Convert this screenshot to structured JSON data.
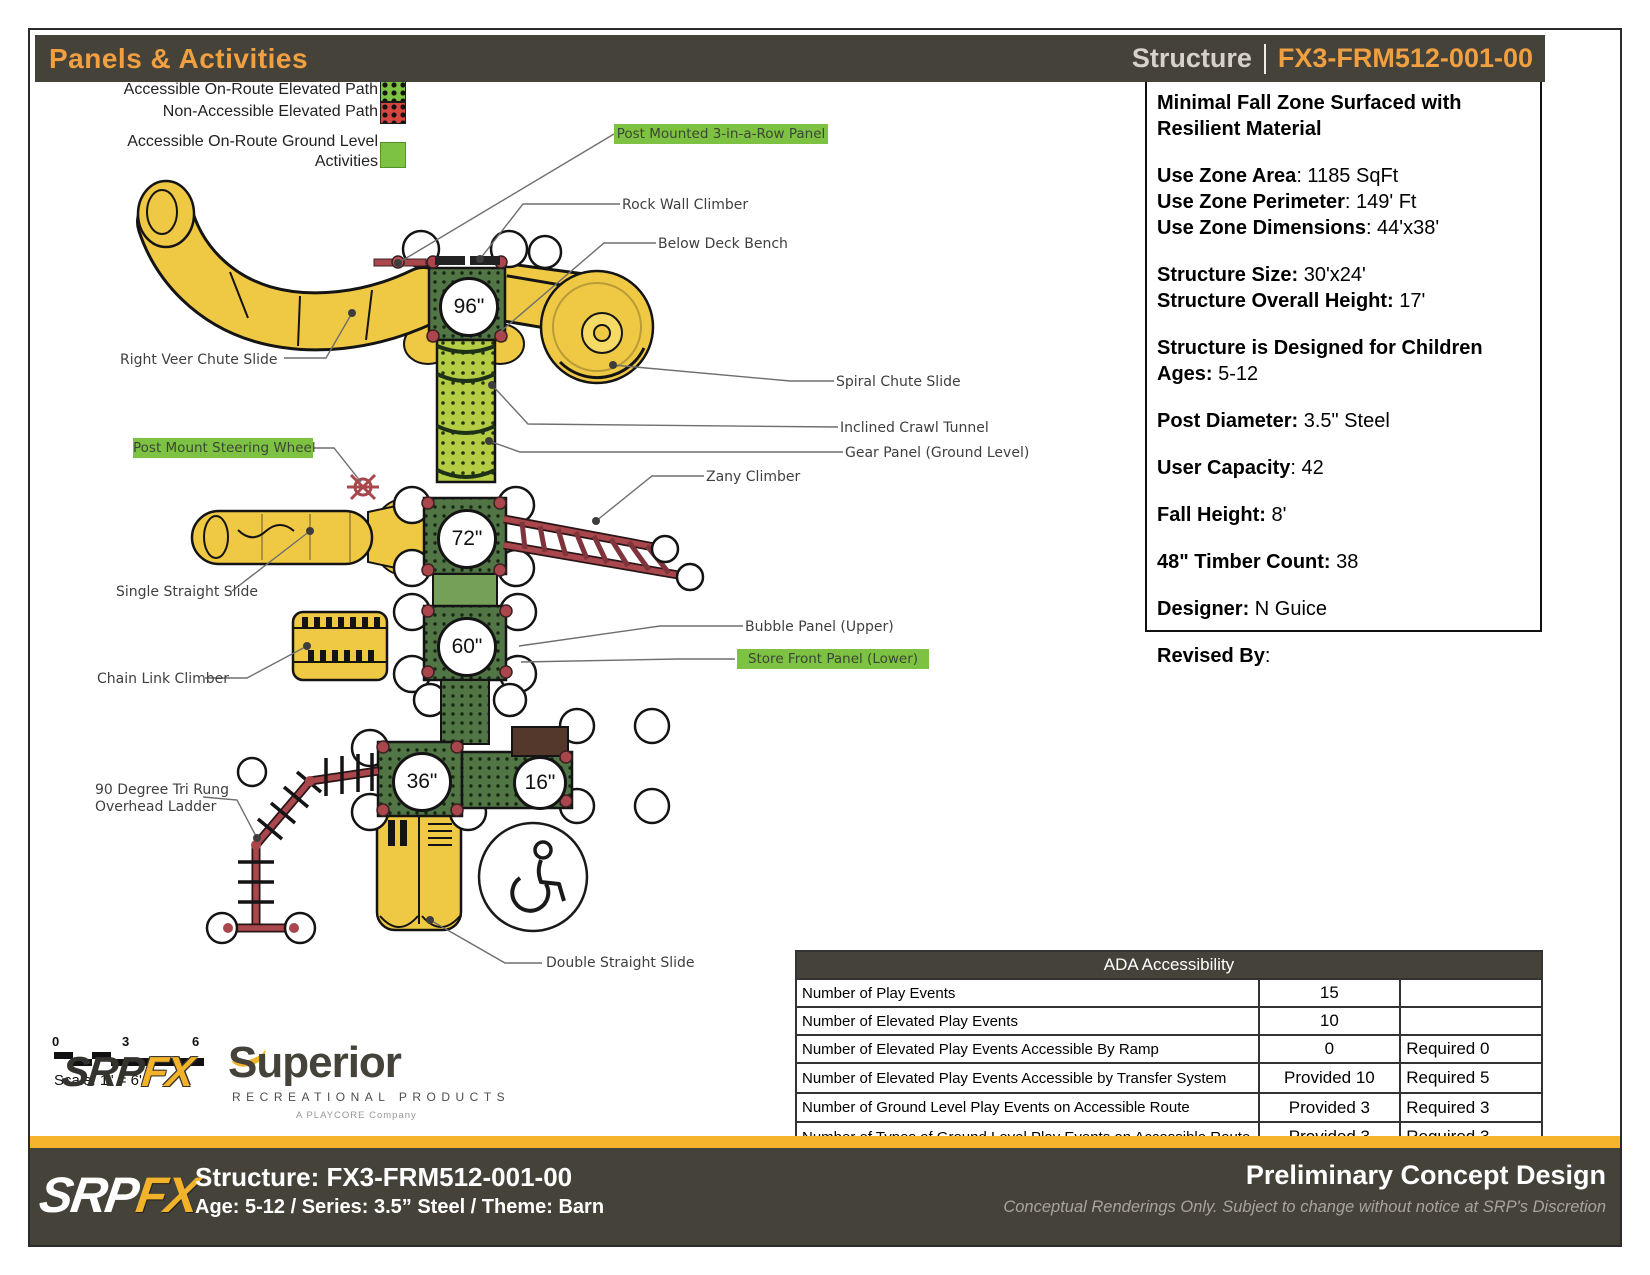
{
  "header": {
    "title": "Panels & Activities",
    "right_label": "Structure",
    "right_code": "FX3-FRM512-001-00"
  },
  "legend": {
    "elevated_accessible": "Accessible On-Route Elevated Path",
    "elevated_non_accessible": "Non-Accessible Elevated Path",
    "ground_line1": "Accessible On-Route Ground Level",
    "ground_line2": "Activities"
  },
  "info_panel": {
    "title": "Minimal Fall Zone Surfaced with Resilient Material",
    "lines": [
      {
        "label": "Use Zone Area",
        "value": ": 1185 SqFt"
      },
      {
        "label": "Use Zone Perimeter",
        "value": ": 149' Ft"
      },
      {
        "label": "Use Zone Dimensions",
        "value": ": 44'x38'"
      },
      {
        "label": "Structure Size:",
        "value": " 30'x24'"
      },
      {
        "label": "Structure Overall Height:",
        "value": " 17'"
      },
      {
        "label": "Structure is Designed for Children Ages:",
        "value": " 5-12"
      },
      {
        "label": "Post Diameter:",
        "value": " 3.5\" Steel"
      },
      {
        "label": "User Capacity",
        "value": ": 42"
      },
      {
        "label": "Fall Height:",
        "value": " 8'"
      },
      {
        "label": "48\" Timber Count:",
        "value": " 38"
      },
      {
        "label": "Designer:",
        "value": " N Guice"
      },
      {
        "label": "Revised By",
        "value": ":"
      }
    ]
  },
  "diagram": {
    "decks": [
      {
        "height": "96\""
      },
      {
        "height": "72\""
      },
      {
        "height": "60\""
      },
      {
        "height": "36\""
      },
      {
        "height": "16\""
      }
    ],
    "callouts": [
      {
        "text": "Post Mounted 3-in-a-Row Panel",
        "highlight": true
      },
      {
        "text": "Rock Wall Climber",
        "highlight": false
      },
      {
        "text": "Below Deck Bench",
        "highlight": false
      },
      {
        "text": "Right Veer Chute Slide",
        "highlight": false
      },
      {
        "text": "Spiral Chute Slide",
        "highlight": false
      },
      {
        "text": "Inclined Crawl Tunnel",
        "highlight": false
      },
      {
        "text": "Gear Panel (Ground Level)",
        "highlight": false
      },
      {
        "text": "Post Mount Steering Wheel",
        "highlight": true
      },
      {
        "text": "Zany Climber",
        "highlight": false
      },
      {
        "text": "Single Straight Slide",
        "highlight": false
      },
      {
        "text": "Bubble Panel (Upper)",
        "highlight": false
      },
      {
        "text": "Store Front Panel (Lower)",
        "highlight": true
      },
      {
        "text": "Chain Link Climber",
        "highlight": false
      },
      {
        "line1": "90 Degree Tri Rung",
        "line2": "Overhead Ladder",
        "highlight": false
      },
      {
        "text": "Double Straight Slide",
        "highlight": false
      }
    ]
  },
  "ada": {
    "title": "ADA Accessibility",
    "rows": [
      {
        "name": "Number of Play Events",
        "provided": "15",
        "required": ""
      },
      {
        "name": "Number of Elevated Play Events",
        "provided": "10",
        "required": ""
      },
      {
        "name": "Number of Elevated Play Events Accessible By Ramp",
        "provided": "0",
        "required": "Required 0"
      },
      {
        "name": "Number of Elevated Play Events Accessible by Transfer System",
        "provided": "Provided 10",
        "required": "Required 5"
      },
      {
        "name": "Number of Ground Level Play Events on Accessible Route",
        "provided": "Provided 3",
        "required": "Required 3"
      },
      {
        "name": "Number of Types of Ground Level Play Events on Accessible Route",
        "provided": "Provided 3",
        "required": "Required 3"
      }
    ]
  },
  "scale": {
    "tick0": "0",
    "tick3": "3",
    "tick6": "6",
    "label": "Scale: 1\" = 6'"
  },
  "logos": {
    "srp": "SRP",
    "fx": "FX",
    "superior": "Superior",
    "superior_sub": "RECREATIONAL PRODUCTS",
    "playcore": "A PLAYCORE Company"
  },
  "footer": {
    "srp": "SRP",
    "fx": "FX",
    "structure_line": "Structure: FX3-FRM512-001-00",
    "meta_line": "Age: 5-12 / Series: 3.5” Steel / Theme: Barn",
    "right_title": "Preliminary Concept Design",
    "right_sub": "Conceptual Renderings Only. Subject to change without notice at SRP's Discretion"
  },
  "colors": {
    "accent_orange": "#f0a040",
    "footer_yellow": "#f6b42c",
    "bar_dark": "#454239",
    "path_green": "#7dc242",
    "path_red": "#d64540",
    "deck_green": "#527546",
    "tunnel_green": "#b5cc45",
    "slide_yellow": "#f0c944",
    "climber_red": "#a9474d"
  }
}
